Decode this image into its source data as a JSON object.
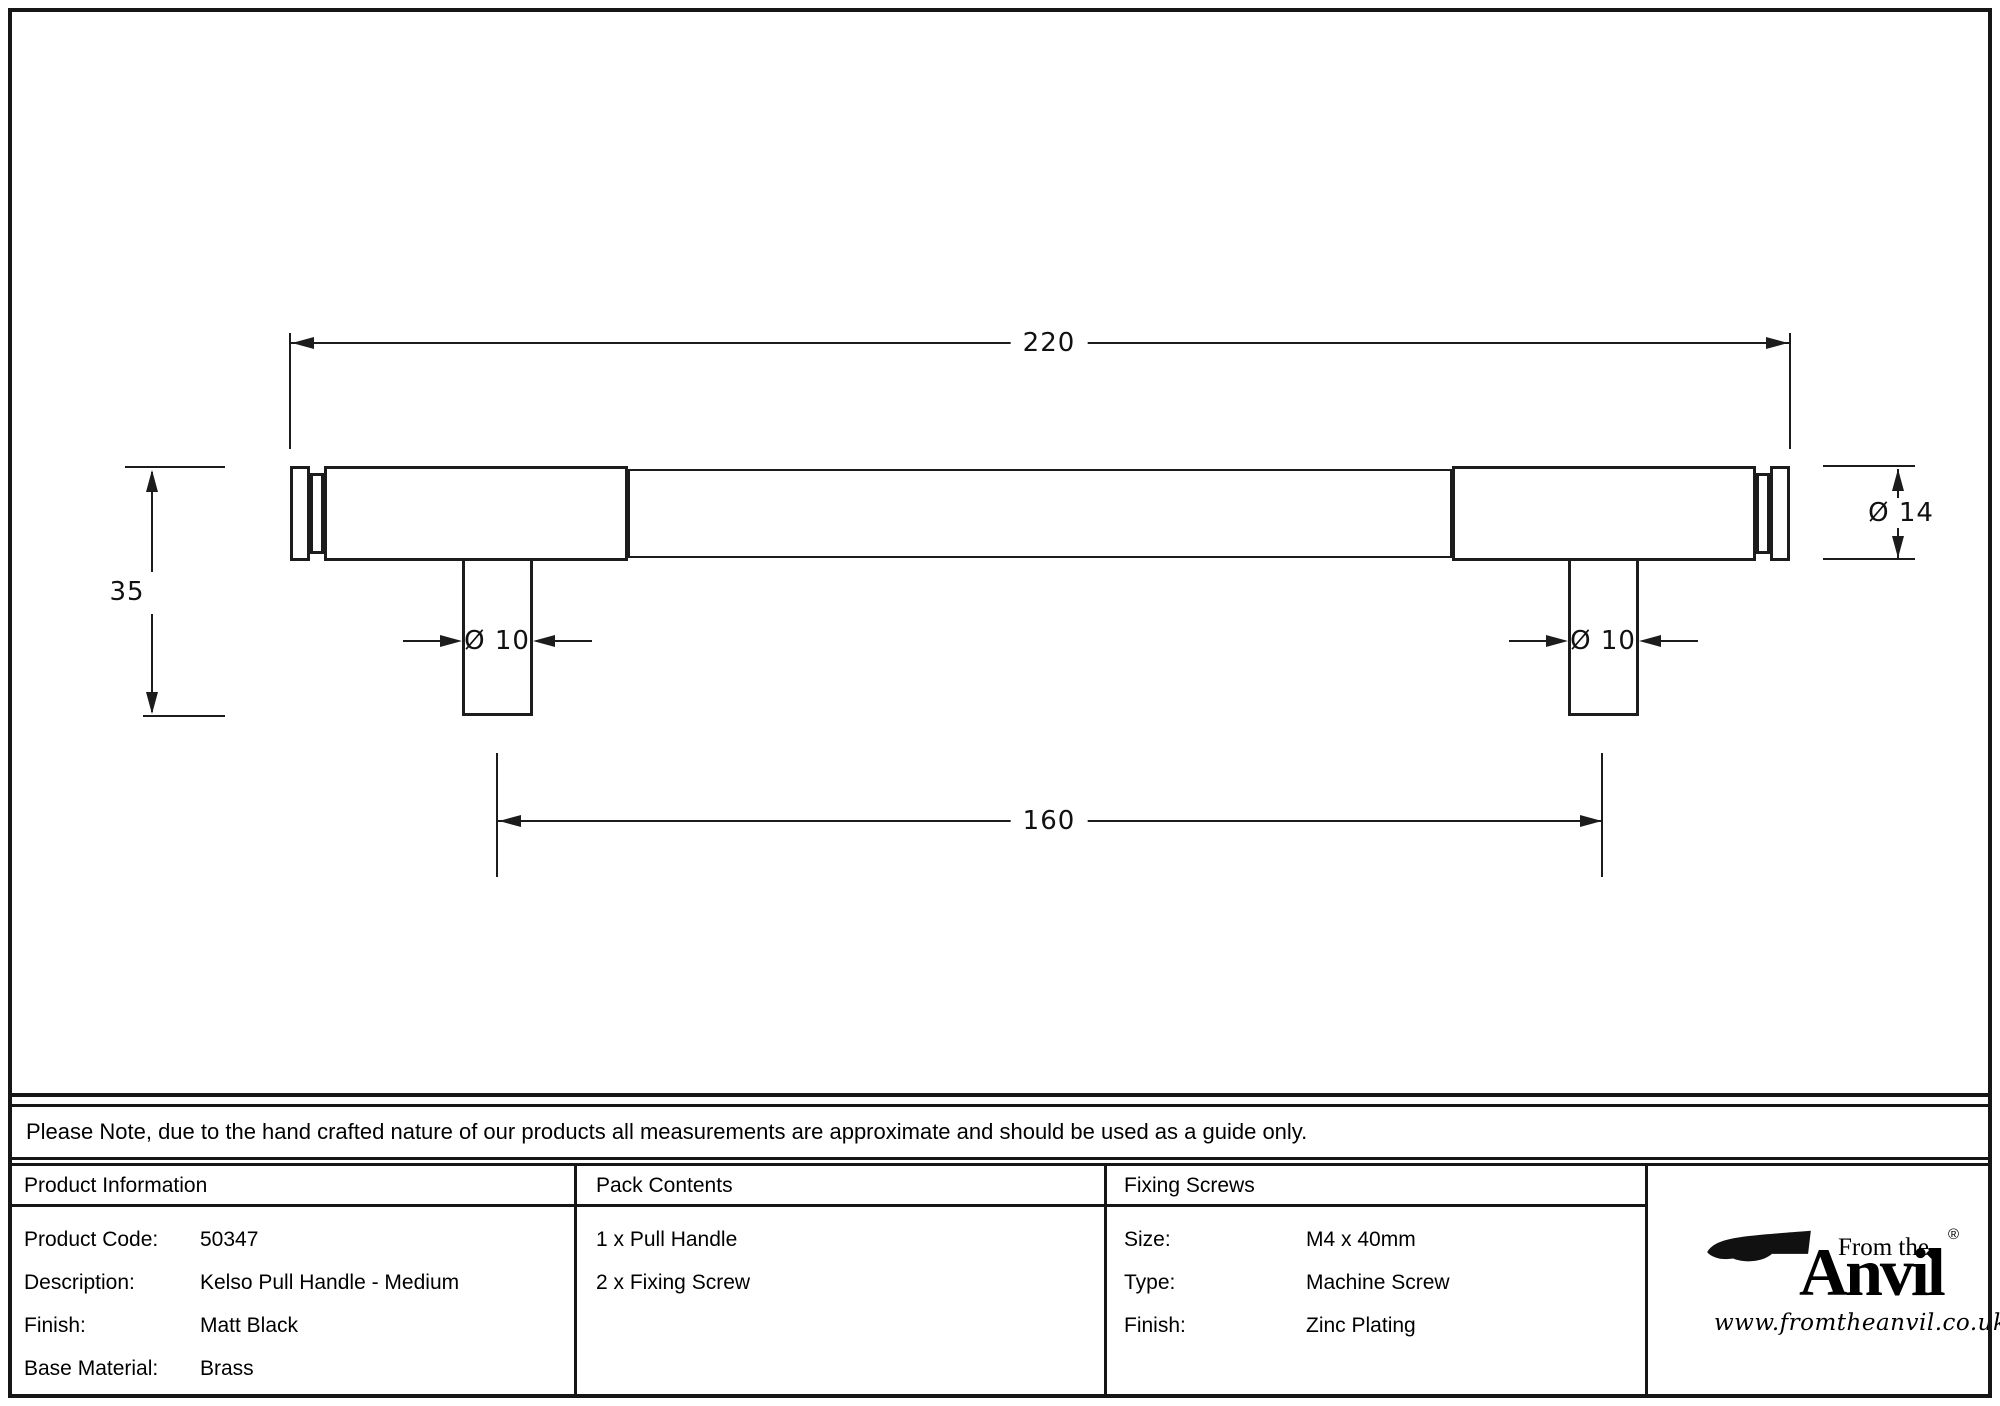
{
  "drawing": {
    "dims": {
      "overall_length": "220",
      "height": "35",
      "end_diameter": "Ø 14",
      "post_diameter": "Ø 10",
      "fixing_centres": "160"
    }
  },
  "note": {
    "text": "Please Note, due to the hand crafted nature of our products all measurements are approximate and should be used as a guide only."
  },
  "table": {
    "product_info": {
      "header": "Product Information",
      "rows": [
        {
          "label": "Product Code:",
          "value": "50347"
        },
        {
          "label": "Description:",
          "value": "Kelso Pull Handle - Medium"
        },
        {
          "label": "Finish:",
          "value": "Matt Black"
        },
        {
          "label": "Base Material:",
          "value": "Brass"
        }
      ]
    },
    "pack_contents": {
      "header": "Pack Contents",
      "items": [
        "1 x Pull Handle",
        "2 x Fixing Screw"
      ]
    },
    "fixing_screws": {
      "header": "Fixing Screws",
      "rows": [
        {
          "label": "Size:",
          "value": "M4 x 40mm"
        },
        {
          "label": "Type:",
          "value": "Machine Screw"
        },
        {
          "label": "Finish:",
          "value": "Zinc Plating"
        }
      ]
    },
    "brand": {
      "tagline": "From the",
      "name": "Anvil",
      "registered": "®",
      "diamond": "◆",
      "url": "www.fromtheanvil.co.uk"
    }
  },
  "colors": {
    "ink": "#161616",
    "line": "#1c1c1c",
    "background": "#ffffff"
  }
}
